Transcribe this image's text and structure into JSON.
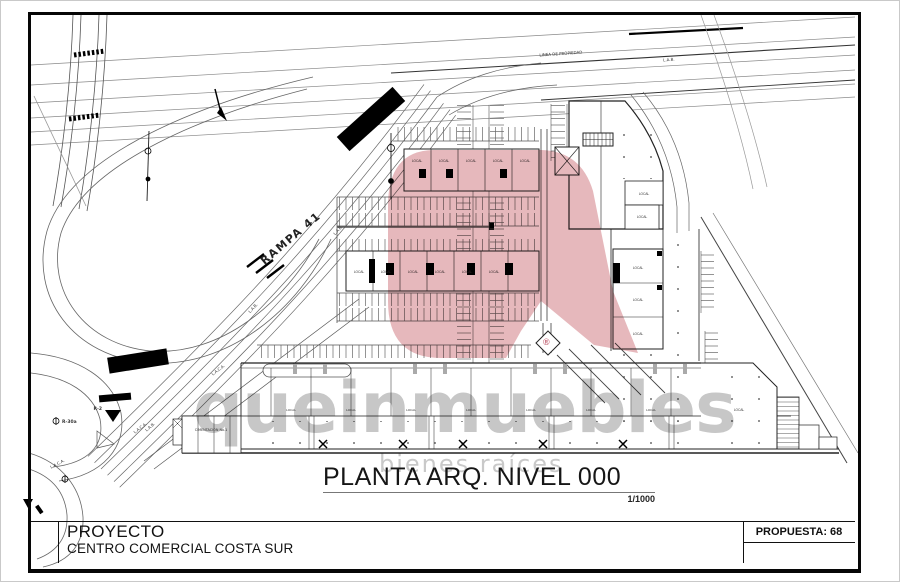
{
  "title_block": {
    "project_label": "PROYECTO",
    "project_name": "CENTRO COMERCIAL COSTA SUR",
    "proposal": "PROPUESTA: 68"
  },
  "drawing_title": {
    "text": "PLANTA ARQ. NIVEL 000",
    "scale": "1/1000"
  },
  "watermark": {
    "brand": "queinmuebles",
    "tagline": "bienes raíces",
    "registered": "®",
    "pin_color": "#c4545f"
  },
  "labels": {
    "ramp": "RAMPA 41",
    "property_line": "LINEA DE PROPIEDAD",
    "lab": "L.A.B.",
    "curve": "L.A.C.A.",
    "sign_r2": "R-2",
    "sign_r30a": "R-30a",
    "foundation": "CIMENTACION No.1",
    "local": "LOCAL"
  }
}
